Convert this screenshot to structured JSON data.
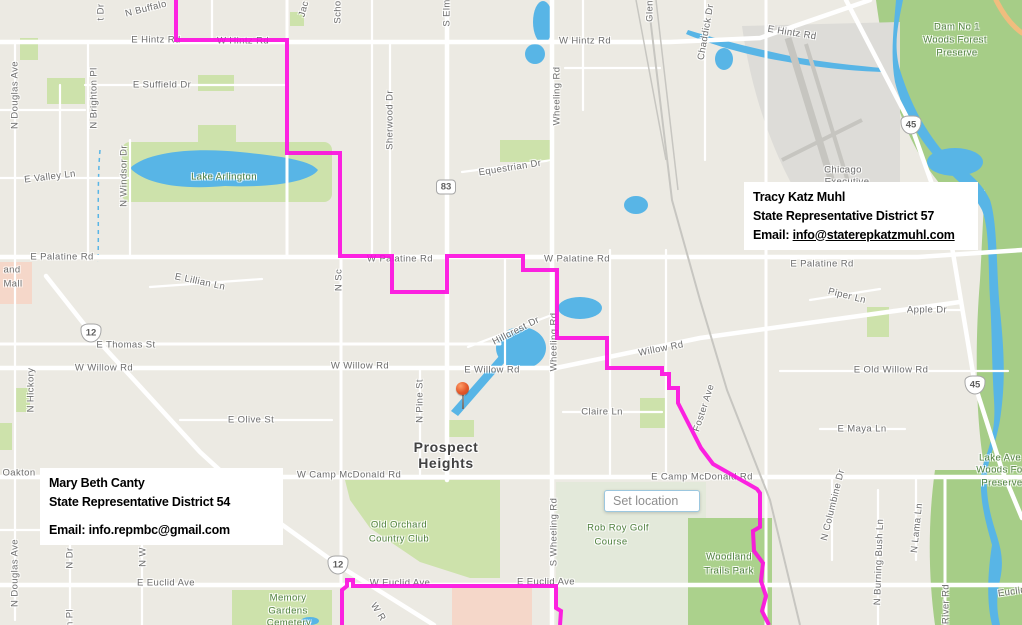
{
  "colors": {
    "boundary": "#fd0bdf",
    "water": "#58b5e6",
    "park": "#cde2ab",
    "preserve": "#a6cd87",
    "pale_green": "#e3e9da",
    "woodland": "#abd18c",
    "pink": "#f5d7c9",
    "road": "#ffffff",
    "background": "#eceae3",
    "label_gray": "#6d6d6d",
    "label_green": "#4e7f3d"
  },
  "info_boxes": {
    "district57": {
      "name": "Tracy Katz Muhl",
      "title": "State Representative District 57",
      "email_label": "Email:",
      "email": "info@staterepkatzmuhl.com"
    },
    "district54": {
      "name": "Mary Beth Canty",
      "title": "State Representative District 54",
      "email_label": "Email:",
      "email": "info.repmbc@gmail.com"
    }
  },
  "set_location": {
    "placeholder": "Set location"
  },
  "pin": {
    "x": 463,
    "y": 388
  },
  "shields": [
    {
      "n": "83",
      "k": "il",
      "x": 446,
      "y": 187
    },
    {
      "n": "12",
      "k": "us",
      "x": 91,
      "y": 333
    },
    {
      "n": "12",
      "k": "us",
      "x": 338,
      "y": 565
    },
    {
      "n": "45",
      "k": "us",
      "x": 911,
      "y": 125
    },
    {
      "n": "45",
      "k": "us",
      "x": 975,
      "y": 385
    }
  ],
  "boundary": {
    "width": 4,
    "opacity": 0.9,
    "lines": [
      [
        [
          176,
          0
        ],
        [
          176,
          40
        ],
        [
          287,
          40
        ],
        [
          287,
          153
        ],
        [
          340,
          153
        ],
        [
          340,
          256
        ],
        [
          392,
          256
        ],
        [
          392,
          292
        ],
        [
          447,
          292
        ],
        [
          447,
          256
        ],
        [
          523,
          256
        ],
        [
          523,
          270
        ],
        [
          557,
          270
        ],
        [
          557,
          338
        ],
        [
          607,
          338
        ],
        [
          607,
          368
        ],
        [
          662,
          368
        ],
        [
          662,
          374
        ],
        [
          669,
          374
        ],
        [
          669,
          388
        ],
        [
          678,
          388
        ],
        [
          678,
          403
        ],
        [
          701,
          448
        ],
        [
          713,
          464
        ],
        [
          757,
          489
        ],
        [
          760,
          493
        ],
        [
          760,
          527
        ],
        [
          753,
          531
        ],
        [
          754,
          551
        ],
        [
          763,
          563
        ],
        [
          761,
          581
        ],
        [
          766,
          596
        ],
        [
          762,
          611
        ],
        [
          769,
          625
        ]
      ],
      [
        [
          342,
          625
        ],
        [
          342,
          590
        ],
        [
          347,
          586
        ],
        [
          347,
          580
        ],
        [
          353,
          580
        ],
        [
          353,
          586
        ],
        [
          556,
          586
        ],
        [
          556,
          608
        ],
        [
          561,
          611
        ],
        [
          560,
          625
        ]
      ]
    ]
  },
  "labels": [
    {
      "t": "N Buffalo",
      "x": 146,
      "y": 9,
      "r": -14
    },
    {
      "t": "t Dr",
      "x": 101,
      "y": 12,
      "r": -90
    },
    {
      "t": "Jac",
      "x": 304,
      "y": 9,
      "r": -75
    },
    {
      "t": "Scho",
      "x": 338,
      "y": 12,
      "r": -90
    },
    {
      "t": "E Hintz Rd",
      "x": 156,
      "y": 40
    },
    {
      "t": "W Hintz Rd",
      "x": 243,
      "y": 41
    },
    {
      "t": "S Elm",
      "x": 447,
      "y": 13,
      "r": -90
    },
    {
      "t": "W Hintz Rd",
      "x": 585,
      "y": 41
    },
    {
      "t": "Glen",
      "x": 650,
      "y": 11,
      "r": -90
    },
    {
      "t": "Chaddick Dr",
      "x": 706,
      "y": 32,
      "r": -80
    },
    {
      "t": "E Hintz Rd",
      "x": 792,
      "y": 33,
      "r": 9
    },
    {
      "t": "Dam No 1",
      "x": 957,
      "y": 27,
      "c": "p"
    },
    {
      "t": "Woods Forest",
      "x": 955,
      "y": 40,
      "c": "p"
    },
    {
      "t": "Preserve",
      "x": 957,
      "y": 53,
      "c": "p"
    },
    {
      "t": "E Suffield Dr",
      "x": 162,
      "y": 85
    },
    {
      "t": "N Douglas Ave",
      "x": 15,
      "y": 95,
      "r": -90
    },
    {
      "t": "N Brighton Pl",
      "x": 94,
      "y": 98,
      "r": -90
    },
    {
      "t": "Sherwood Dr",
      "x": 390,
      "y": 120,
      "r": -90
    },
    {
      "t": "Wheeling Rd",
      "x": 557,
      "y": 96,
      "r": -90
    },
    {
      "t": "E Valley Ln",
      "x": 50,
      "y": 177,
      "r": -7
    },
    {
      "t": "N Windsor Dr",
      "x": 124,
      "y": 176,
      "r": -90
    },
    {
      "t": "Lake Arlington",
      "x": 224,
      "y": 177,
      "c": "p"
    },
    {
      "t": "Equestrian Dr",
      "x": 510,
      "y": 168,
      "r": -9
    },
    {
      "t": "Chicago",
      "x": 843,
      "y": 170
    },
    {
      "t": "Executive",
      "x": 847,
      "y": 182
    },
    {
      "t": "E Palatine Rd",
      "x": 62,
      "y": 257
    },
    {
      "t": "W Palatine Rd",
      "x": 400,
      "y": 259
    },
    {
      "t": "W Palatine Rd",
      "x": 577,
      "y": 259
    },
    {
      "t": "E Palatine Rd",
      "x": 822,
      "y": 264
    },
    {
      "t": "and",
      "x": 12,
      "y": 270
    },
    {
      "t": "Mall",
      "x": 13,
      "y": 284
    },
    {
      "t": "E Lillian Ln",
      "x": 200,
      "y": 282,
      "r": 12
    },
    {
      "t": "N Sc",
      "x": 339,
      "y": 280,
      "r": -90
    },
    {
      "t": "Piper Ln",
      "x": 847,
      "y": 296,
      "r": 14
    },
    {
      "t": "Apple Dr",
      "x": 927,
      "y": 310
    },
    {
      "t": "E Thomas St",
      "x": 126,
      "y": 345
    },
    {
      "t": "N Hickory",
      "x": 31,
      "y": 390,
      "r": -90
    },
    {
      "t": "Hillcrest Dr",
      "x": 516,
      "y": 331,
      "r": -27
    },
    {
      "t": "Willow Rd",
      "x": 661,
      "y": 349,
      "r": -11
    },
    {
      "t": "W Willow Rd",
      "x": 104,
      "y": 368
    },
    {
      "t": "W Willow Rd",
      "x": 360,
      "y": 366
    },
    {
      "t": "E Willow Rd",
      "x": 492,
      "y": 370
    },
    {
      "t": "Wheeling Rd",
      "x": 554,
      "y": 342,
      "r": -90
    },
    {
      "t": "E Old Willow Rd",
      "x": 891,
      "y": 370
    },
    {
      "t": "N Pine St",
      "x": 420,
      "y": 401,
      "r": -90
    },
    {
      "t": "Claire Ln",
      "x": 602,
      "y": 412
    },
    {
      "t": "E Maya Ln",
      "x": 862,
      "y": 429
    },
    {
      "t": "Foster Ave",
      "x": 704,
      "y": 408,
      "r": -72
    },
    {
      "t": "E Olive St",
      "x": 251,
      "y": 420
    },
    {
      "t": "Prospect",
      "x": 446,
      "y": 447,
      "c": "city"
    },
    {
      "t": "Heights",
      "x": 446,
      "y": 463,
      "c": "city"
    },
    {
      "t": "Oakton",
      "x": 19,
      "y": 473
    },
    {
      "t": "W Camp McDonald Rd",
      "x": 349,
      "y": 475
    },
    {
      "t": "E Camp McDonald Rd",
      "x": 702,
      "y": 477
    },
    {
      "t": "Lake Ave",
      "x": 1000,
      "y": 458,
      "c": "p"
    },
    {
      "t": "Woods Fore",
      "x": 1004,
      "y": 470,
      "c": "p"
    },
    {
      "t": "Preserve",
      "x": 1002,
      "y": 483,
      "c": "p"
    },
    {
      "t": "Old Orchard",
      "x": 399,
      "y": 525,
      "c": "p"
    },
    {
      "t": "Country Club",
      "x": 399,
      "y": 539,
      "c": "p"
    },
    {
      "t": "Rob Roy Golf",
      "x": 618,
      "y": 528,
      "c": "p"
    },
    {
      "t": "Course",
      "x": 611,
      "y": 542,
      "c": "p"
    },
    {
      "t": "Woodland",
      "x": 729,
      "y": 557,
      "c": "p"
    },
    {
      "t": "Trails Park",
      "x": 729,
      "y": 571,
      "c": "p"
    },
    {
      "t": "S Wheeling Rd",
      "x": 554,
      "y": 532,
      "r": -90
    },
    {
      "t": "N Columbine Dr",
      "x": 833,
      "y": 505,
      "r": -76
    },
    {
      "t": "N Burning Bush Ln",
      "x": 879,
      "y": 562,
      "r": -88
    },
    {
      "t": "N Lama Ln",
      "x": 917,
      "y": 528,
      "r": -84
    },
    {
      "t": "N Douglas Ave",
      "x": 15,
      "y": 573,
      "r": -90
    },
    {
      "t": "N Dr",
      "x": 70,
      "y": 558,
      "r": -90
    },
    {
      "t": "N W",
      "x": 143,
      "y": 557,
      "r": -90
    },
    {
      "t": "E Euclid Ave",
      "x": 166,
      "y": 583
    },
    {
      "t": "W Euclid Ave",
      "x": 400,
      "y": 583
    },
    {
      "t": "E Euclid Ave",
      "x": 546,
      "y": 582
    },
    {
      "t": "Euclid",
      "x": 1012,
      "y": 592,
      "r": -8
    },
    {
      "t": "Memory",
      "x": 288,
      "y": 598,
      "c": "p"
    },
    {
      "t": "Gardens",
      "x": 288,
      "y": 611,
      "c": "p"
    },
    {
      "t": "Cemetery",
      "x": 289,
      "y": 623,
      "c": "p"
    },
    {
      "t": "W R",
      "x": 378,
      "y": 612,
      "r": 58
    },
    {
      "t": "River Rd",
      "x": 946,
      "y": 604,
      "r": -90
    },
    {
      "t": "n Pl",
      "x": 70,
      "y": 618,
      "r": -90
    }
  ]
}
